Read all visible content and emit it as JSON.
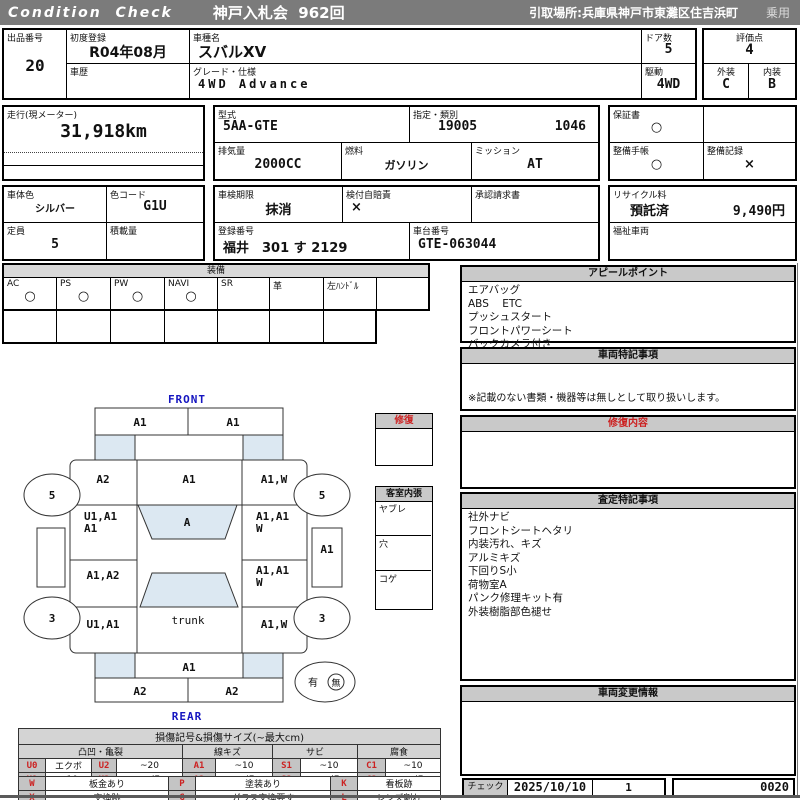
{
  "colors": {
    "header_bg": "#7b7b7b",
    "panel_header_bg": "#c9c9c9",
    "damage_red": "#cc2222",
    "label_blue": "#1515c0",
    "glass_shade": "#dce8f2"
  },
  "header": {
    "brand": "Condition  Check",
    "auction": "神戸入札会  962回",
    "pickup": "引取場所:兵庫県神戸市東灘区住吉浜町",
    "vehicle_class": "乗用"
  },
  "info": {
    "lot_label": "出品番号",
    "lot_no": "20",
    "first_reg_label": "初度登録",
    "first_reg": "R04年08月",
    "history_label": "車歴",
    "history": "",
    "model_label": "車種名",
    "model": "スバルXV",
    "grade_label": "グレード・仕様",
    "grade": "4WD Advance",
    "doors_label": "ドア数",
    "doors": "5",
    "drive_label": "駆動",
    "drive": "4WD",
    "score_label": "評価点",
    "score": "4",
    "exterior_label": "外装",
    "exterior": "C",
    "interior_label": "内装",
    "interior": "B",
    "mileage_label": "走行(現メーター)",
    "mileage": "31,918km",
    "type_label": "型式",
    "type": "5AA-GTE",
    "class_label": "指定・類別",
    "class_no1": "19005",
    "class_no2": "1046",
    "displacement_label": "排気量",
    "displacement": "2000CC",
    "fuel_label": "燃料",
    "fuel": "ガソリン",
    "transmission_label": "ミッション",
    "transmission": "AT",
    "warranty_label": "保証書",
    "warranty": "○",
    "service_book_label": "整備手帳",
    "service_book": "○",
    "service_record_label": "整備記録",
    "service_record": "×",
    "body_color_label": "車体色",
    "body_color": "シルバー",
    "color_code_label": "色コード",
    "color_code": "G1U",
    "inspection_label": "車検期限",
    "inspection": "抹消",
    "insurance_label": "検付自賠責",
    "insurance": "×",
    "approval_label": "承認請求書",
    "approval": "",
    "recycle_label": "リサイクル料",
    "recycle_status": "預託済",
    "recycle_fee": "9,490円",
    "capacity_label": "定員",
    "capacity": "5",
    "load_label": "積載量",
    "load": "",
    "reg_no_label": "登録番号",
    "reg_no": "福井　301 す 2129",
    "chassis_label": "車台番号",
    "chassis": "GTE-063044",
    "welfare_label": "福祉車両",
    "welfare": ""
  },
  "equipment": {
    "title": "装備",
    "items": [
      {
        "label": "AC",
        "value": "○"
      },
      {
        "label": "PS",
        "value": "○"
      },
      {
        "label": "PW",
        "value": "○"
      },
      {
        "label": "NAVI",
        "value": "○"
      },
      {
        "label": "SR",
        "value": ""
      },
      {
        "label": "革",
        "value": ""
      },
      {
        "label": "左ﾊﾝﾄﾞﾙ",
        "value": ""
      },
      {
        "label": "",
        "value": ""
      }
    ]
  },
  "panels": {
    "appeal": {
      "title": "アピールポイント",
      "lines": [
        "エアバッグ",
        "ABS    ETC",
        "プッシュスタート",
        "フロントパワーシート",
        "バックカメラ付き"
      ]
    },
    "vehicle_notes": {
      "title": "車両特記事項",
      "note": "※記載のない書類・機器等は無しとして取り扱いします。"
    },
    "repair_details": {
      "title": "修復内容"
    },
    "assessment": {
      "title": "査定特記事項",
      "lines": [
        "社外ナビ",
        "フロントシートヘタリ",
        "内装汚れ、キズ",
        "アルミキズ",
        "下回りS小",
        "荷物室A",
        "パンク修理キット有",
        "外装樹脂部色褪せ"
      ]
    },
    "change_info": {
      "title": "車両変更情報"
    }
  },
  "side_boxes": {
    "repair": {
      "title": "修復"
    },
    "cabin": {
      "title": "客室内張",
      "rows": [
        "ヤブレ",
        "穴",
        "コゲ"
      ]
    }
  },
  "diagram": {
    "front_label": "FRONT",
    "rear_label": "REAR",
    "trunk_label": "trunk",
    "front_bumper_left": "A1",
    "front_bumper_right": "A1",
    "front_fender_left": "A2",
    "hood": "A1",
    "front_fender_right": "A1,W",
    "front_door_left_1": "U1,A1",
    "front_door_left_2": "A1",
    "windshield": "A",
    "front_door_right_1": "A1,A1",
    "front_door_right_2": "W",
    "right_sill": "A1",
    "rear_door_left": "A1,A2",
    "rear_door_right_1": "A1,A1",
    "rear_door_right_2": "W",
    "quarter_left": "U1,A1",
    "quarter_right": "A1,W",
    "rear_panel": "A1",
    "rear_bumper_left": "A2",
    "rear_bumper_right": "A2",
    "wheel_front_left": "5",
    "wheel_front_right": "5",
    "wheel_rear_left": "3",
    "wheel_rear_right": "3",
    "spare_yes": "有",
    "spare_no": "無"
  },
  "legend": {
    "title": "損傷記号&損傷サイズ(~最大cm)",
    "groups": [
      "凸凹・亀裂",
      "線キズ",
      "サビ",
      "腐食"
    ],
    "row1": [
      "U0",
      "エクボ",
      "U2",
      "~20",
      "A1",
      "~10",
      "S1",
      "~10",
      "C1",
      "~10"
    ],
    "row2": [
      "U1",
      "~10",
      "U3",
      "20超",
      "A2",
      "10超",
      "S2",
      "10超",
      "C2",
      "10超"
    ],
    "row3": [
      "W",
      "板金あり",
      "P",
      "塗装あり",
      "K",
      "看板跡"
    ],
    "row4": [
      "X",
      "交換跡",
      "G",
      "ガラス交換要す",
      "L",
      "レンズ割れ"
    ]
  },
  "check": {
    "label": "チェック",
    "date": "2025/10/10",
    "count": "1",
    "code": "0020"
  }
}
